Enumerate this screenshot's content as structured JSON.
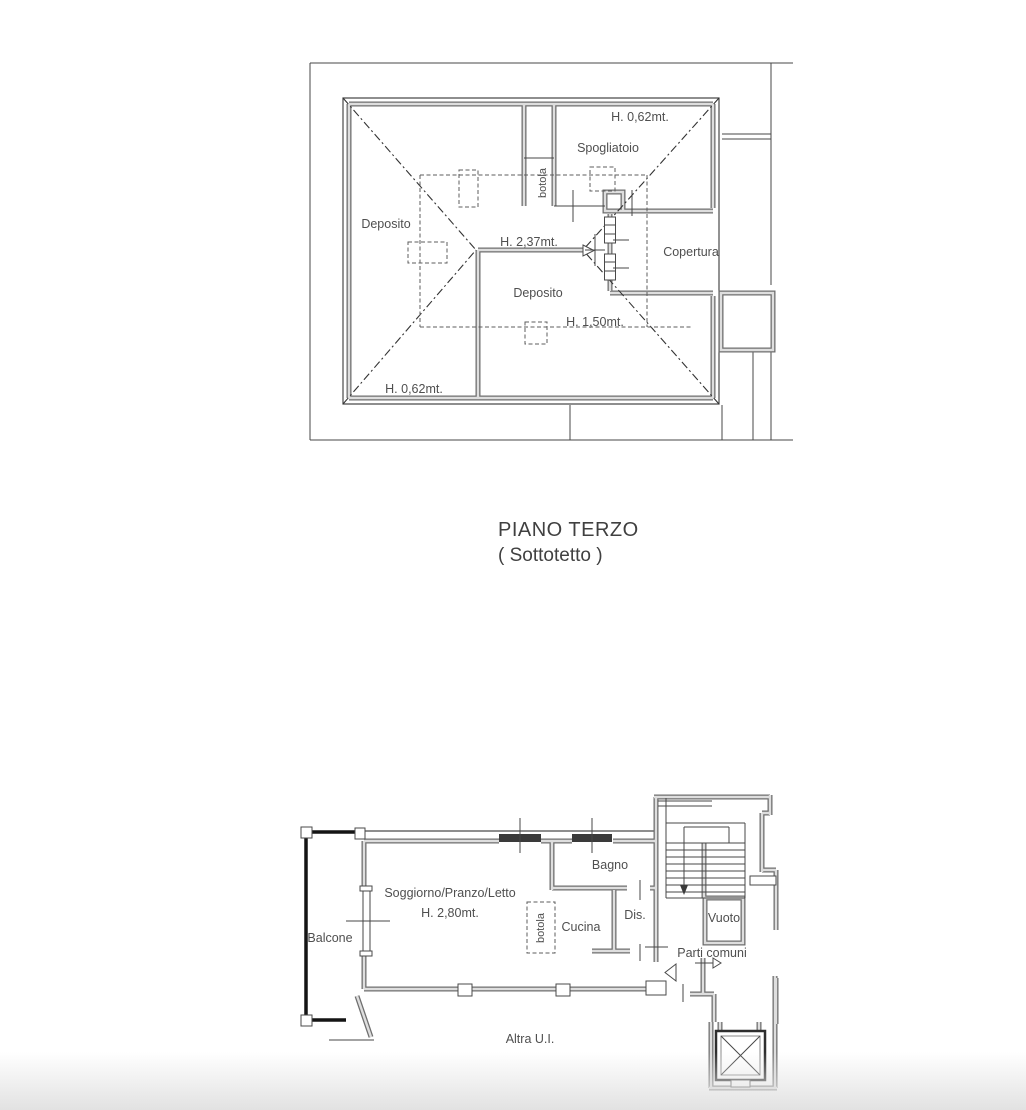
{
  "colors": {
    "background": "#ffffff",
    "wall_gray": "#6f6f6f",
    "line_dark": "#474747",
    "text_gray": "#4f4f4f",
    "railing_black": "#141414",
    "footer_fade": "#e2e2e2"
  },
  "title": {
    "line1": "PIANO TERZO",
    "line2": "( Sottotetto )"
  },
  "plan_top": {
    "name": "piano-terzo-sottotetto",
    "labels": {
      "h_top": "H. 0,62mt.",
      "spogliatoio": "Spogliatoio",
      "botola": "botola",
      "deposito_left": "Deposito",
      "h_ridge": "H. 2,37mt.",
      "copertura": "Copertura",
      "deposito_center": "Deposito",
      "h_mid": "H. 1,50mt.",
      "h_bottom": "H. 0,62mt."
    }
  },
  "plan_bottom": {
    "name": "apartment-floor",
    "labels": {
      "balcone": "Balcone",
      "soggiorno": "Soggiorno/Pranzo/Letto",
      "h_soggiorno": "H. 2,80mt.",
      "botola": "botola",
      "cucina": "Cucina",
      "bagno": "Bagno",
      "dis": "Dis.",
      "vuoto": "Vuoto",
      "parti_comuni": "Parti comuni",
      "altra_ui": "Altra U.I."
    }
  }
}
